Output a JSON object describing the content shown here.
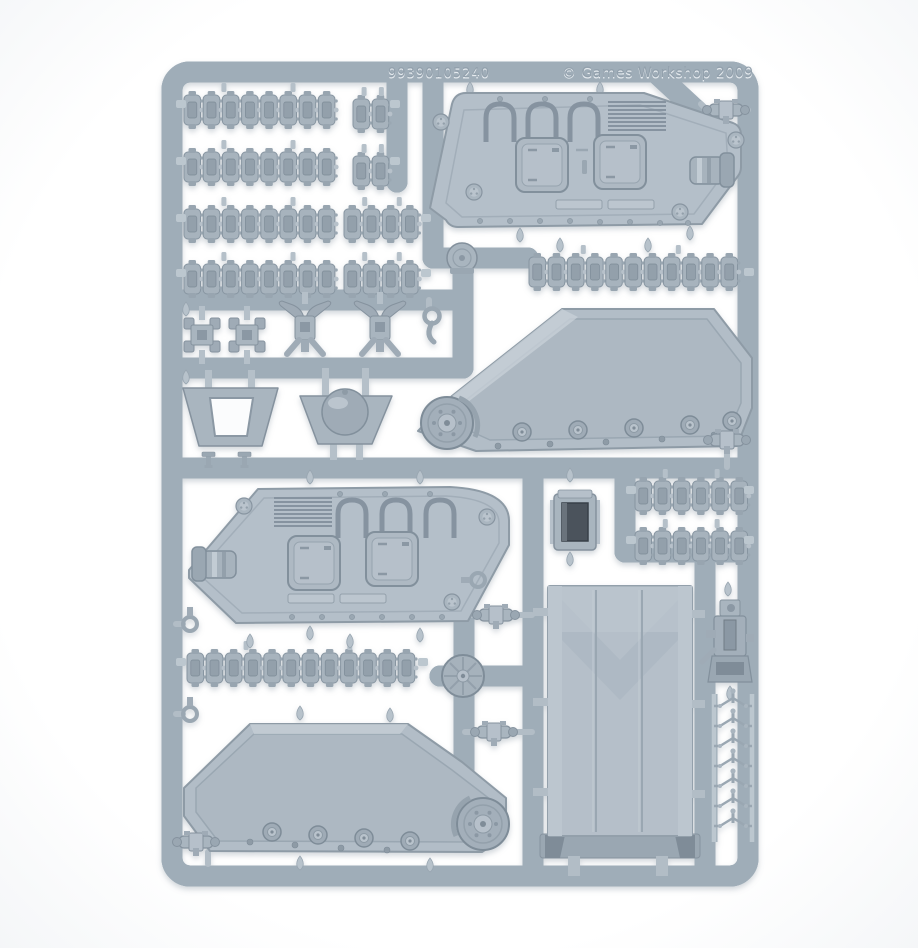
{
  "image": {
    "subject": "Light grey plastic injection-moulded model kit sprue for a tank kit, photographed on a white background",
    "background_color": "#ffffff"
  },
  "molded_text": {
    "part_code": "99390105240",
    "copyright": "© Games Workshop 2009"
  },
  "colors": {
    "runner_light": "#d8dfe5",
    "runner_mid": "#c2ccd4",
    "runner_shadow": "#9fadb8",
    "part_light": "#c6cfd6",
    "part_mid": "#aeb9c3",
    "part_dark": "#93a0ab",
    "part_deep": "#78848f",
    "hole_dark": "#4b535b"
  },
  "parts_inventory": [
    {
      "name": "track-link-strip",
      "count": 12
    },
    {
      "name": "hull-side-panel",
      "count": 2
    },
    {
      "name": "track-assembly-panel",
      "count": 2
    },
    {
      "name": "ramp-panel",
      "count": 1
    },
    {
      "name": "searchlight-box",
      "count": 1
    },
    {
      "name": "road-wheel-disc",
      "count": 2
    },
    {
      "name": "dome-hatch",
      "count": 1
    },
    {
      "name": "hatch-frame",
      "count": 1
    },
    {
      "name": "sprocket-mount",
      "count": 2
    },
    {
      "name": "shackle-bracket",
      "count": 2
    },
    {
      "name": "coupling-bracket",
      "count": 5
    },
    {
      "name": "eyelet",
      "count": 3
    },
    {
      "name": "tripod-pin",
      "count": 7
    },
    {
      "name": "gun-mount-assembly",
      "count": 1
    },
    {
      "name": "hook",
      "count": 1
    },
    {
      "name": "bolt",
      "count": 2
    }
  ]
}
